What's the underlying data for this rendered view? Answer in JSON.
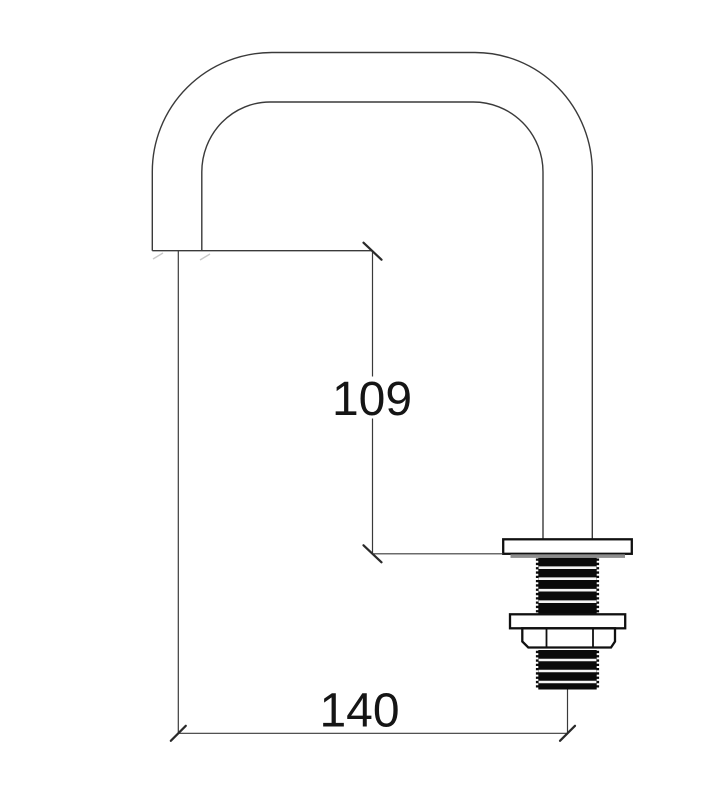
{
  "drawing": {
    "view": "faucet-spout-side-elevation",
    "dimensions": {
      "vertical": {
        "label": "109",
        "value": 109
      },
      "horizontal": {
        "label": "140",
        "value": 140
      }
    },
    "colors": {
      "background": "#ffffff",
      "outline": "#3a3a3a",
      "heavy_outline": "#101010",
      "thread_fill": "#0a0a0a",
      "flange_shadow": "#8d8d8d",
      "dimension_text": "#151515"
    }
  }
}
